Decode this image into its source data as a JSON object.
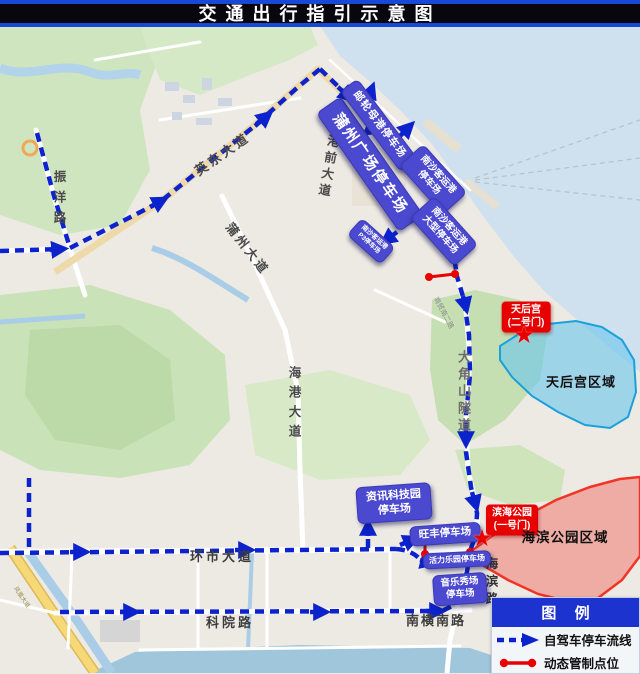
{
  "title": "交通出行指引示意图",
  "colors": {
    "route_blue": "#0c22cc",
    "control_red": "#e90000",
    "parking_label_bg": "#4a49cf",
    "gate_label_bg": "#e60000",
    "legend_header_bg": "#1d33cf",
    "sea": "#cfe0ee",
    "region_tianhou_border": "#1ba0dc",
    "region_haibin_border": "#f03428"
  },
  "roads": [
    {
      "id": "zhenyang",
      "text": "振洋路"
    },
    {
      "id": "yingdong",
      "text": "英东大道"
    },
    {
      "id": "gangqian",
      "text": "港前大道"
    },
    {
      "id": "puzhou",
      "text": "蒲州大道"
    },
    {
      "id": "shangmao",
      "text": "商贸南二路"
    },
    {
      "id": "haigang",
      "text": "海港大道"
    },
    {
      "id": "dajiaoshan",
      "text": "大角山隧道"
    },
    {
      "id": "huanshi",
      "text": "环市大道"
    },
    {
      "id": "keyuan",
      "text": "科院路"
    },
    {
      "id": "nanheng",
      "text": "南横南路"
    },
    {
      "id": "haibinlu",
      "text": "海滨路"
    },
    {
      "id": "fenghuang",
      "text": "凤凰大道"
    }
  ],
  "parkings": [
    {
      "id": "puzhou-square",
      "text": "蒲州广场停车场"
    },
    {
      "id": "cruise-port",
      "text": "邮轮母港停车场"
    },
    {
      "id": "nansha-port",
      "text": "南沙客运港\n停车场"
    },
    {
      "id": "nansha-large",
      "text": "南沙客运港\n大型停车场"
    },
    {
      "id": "nansha-p3",
      "text": "南沙客运港\nP3停车场"
    },
    {
      "id": "infotech",
      "text": "资讯科技园\n停车场"
    },
    {
      "id": "wangfeng",
      "text": "旺丰停车场"
    },
    {
      "id": "vitality",
      "text": "活力乐园停车场"
    },
    {
      "id": "music-show",
      "text": "音乐秀场\n停车场"
    }
  ],
  "gates": [
    {
      "id": "tianhou-gate2",
      "text": "天后宫\n(二号门)"
    },
    {
      "id": "binhai-gate1",
      "text": "滨海公园\n(一号门)"
    }
  ],
  "regions": [
    {
      "id": "tianhou",
      "label": "天后宫区域"
    },
    {
      "id": "haibin",
      "label": "海滨公园区域"
    }
  ],
  "legend": {
    "header": "图 例",
    "items": [
      {
        "id": "route",
        "label": "自驾车停车流线"
      },
      {
        "id": "control",
        "label": "动态管制点位"
      }
    ]
  }
}
